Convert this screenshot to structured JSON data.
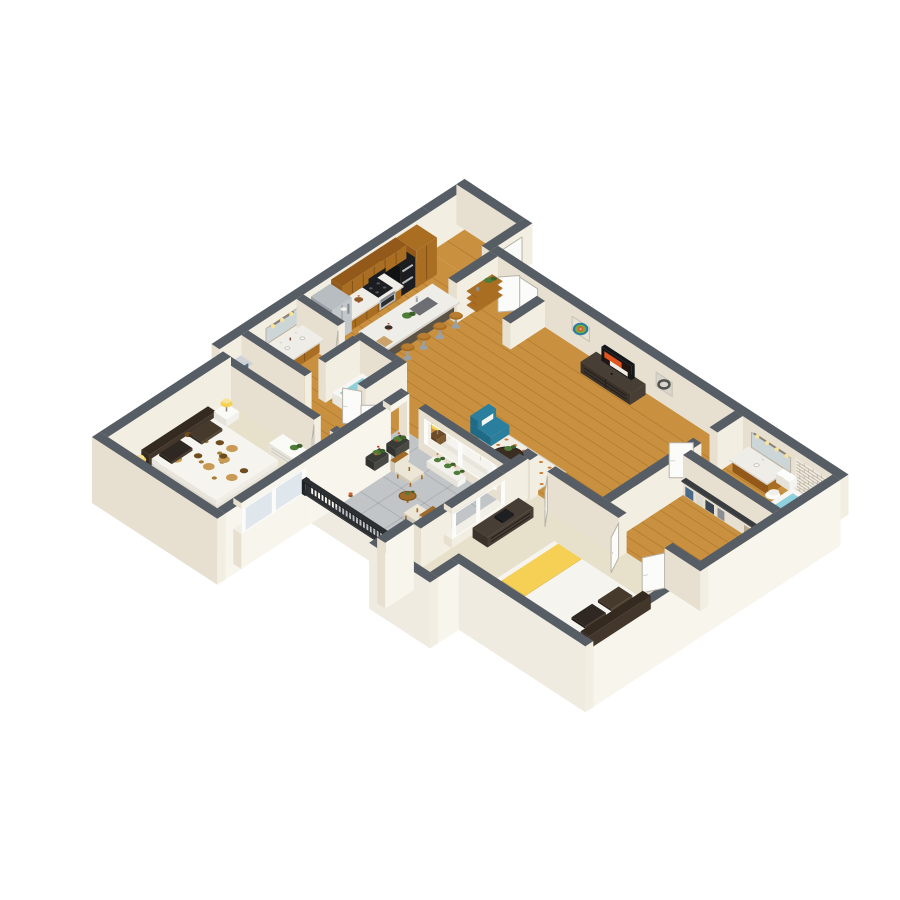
{
  "scene": {
    "subject": "Isometric 3D floor plan rendering of a two-bedroom two-bathroom apartment with open kitchen, living-dining area and balcony",
    "background": "#ffffff",
    "view": "isometric"
  },
  "rooms": [
    {
      "id": "entry",
      "label": "entry-foyer"
    },
    {
      "id": "kitchen",
      "label": "kitchen"
    },
    {
      "id": "dining",
      "label": "dining-area"
    },
    {
      "id": "living",
      "label": "living-room"
    },
    {
      "id": "bath1",
      "label": "bathroom-1"
    },
    {
      "id": "closet1",
      "label": "walk-in-closet-1"
    },
    {
      "id": "bedroom1",
      "label": "bedroom-1"
    },
    {
      "id": "bath2",
      "label": "bathroom-2"
    },
    {
      "id": "closet2",
      "label": "walk-in-closet-2"
    },
    {
      "id": "bedroom2",
      "label": "bedroom-2"
    },
    {
      "id": "balcony",
      "label": "balcony-patio"
    }
  ],
  "furnishings": {
    "bar_stools": 4,
    "dining_chairs": 4,
    "balcony_chairs": 2,
    "beds": 2,
    "vanities": 2,
    "toilets": 2,
    "bathtubs": 2,
    "wall_art_pieces": 2,
    "televisions": 1
  },
  "palette": {
    "background": "#ffffff",
    "wall_cap": "#565d64",
    "wall_cap_dark": "#464d53",
    "wall_inner_lit": "#f3eee2",
    "wall_inner_shade": "#e7e0d0",
    "wall_outer_lit": "#f8f5ed",
    "wall_outer_shade": "#efebe0",
    "floor_wood": "#c9913f",
    "plank_line": "rgba(140,90,30,0.38)",
    "carpet": "#e7e0ca",
    "concrete": "#c1c5c7",
    "tile_line": "rgba(115,120,124,0.30)",
    "marble": "#efede8",
    "marble_side": "#dbd7cf",
    "cab_wood": "#aa6e23",
    "cab_wood_dark": "#93591a",
    "cab_seam": "rgba(70,40,8,0.40)",
    "island_base": "#4d453b",
    "island_base_lit": "#5c5347",
    "stainless": "#b8bdc1",
    "stainless_dark": "#9aa0a5",
    "appliance_black": "#1b1d20",
    "door_white": "#fbfbf9",
    "door_edge": "#b7b2a8",
    "rail_black": "#2c2f32",
    "water_blue": "#8ed0dc",
    "brick_bg": "#f0ebe1",
    "brick_line": "rgba(160,150,128,0.55)",
    "denim_blue": "#4a6a8a",
    "cloth_white": "#dcd9d2",
    "cloth_gray": "#8a8f96",
    "cloth_navy": "#3b4452",
    "cloth_tan": "#b9a98c",
    "plant_green": "#4e7d37",
    "plant_dark": "#3c622a",
    "flower_orange": "#d4622a",
    "flower_red": "#b93a20",
    "rug_base": "#f1eee4",
    "rug_dot": "#cf7a33",
    "bed_white": "#f6f4ee",
    "bed_side": "#e8e5dc",
    "floral_brown": "#a77a33",
    "floral_dark": "#6e4c1e",
    "pillow_dark": "#463a2d",
    "pillow_darker": "#2f2721",
    "headboard_dark": "#342a20",
    "dresser_dark": "#3a322b",
    "dresser_dark_lit": "#473e35",
    "dresser_white": "#fafaf7",
    "wood_chair": "#a06a28",
    "wood_chair_dark": "#7d4f1c",
    "cushion_cream": "#ece6d6",
    "teal": "#2a7f9e",
    "teal_dark": "#1f6a86",
    "lamp_yellow": "#f5d054",
    "lamp_glow": "#f8e29a",
    "glass": "#dfe7ec",
    "mirror": "#ccd6d6",
    "tv_black": "#141619",
    "screen_orange": "#e05420",
    "screen_white": "#f0ece4",
    "screen_teal": "#2a7f9e",
    "art_teal": "#2a7f9e",
    "art_green": "#7da83c",
    "art_orange": "#d4622a",
    "art_bg": "#e8e2d6",
    "art2_bg": "#d9d5cd",
    "art2_dark": "#50524f",
    "sink_gray": "#6b6f73"
  }
}
